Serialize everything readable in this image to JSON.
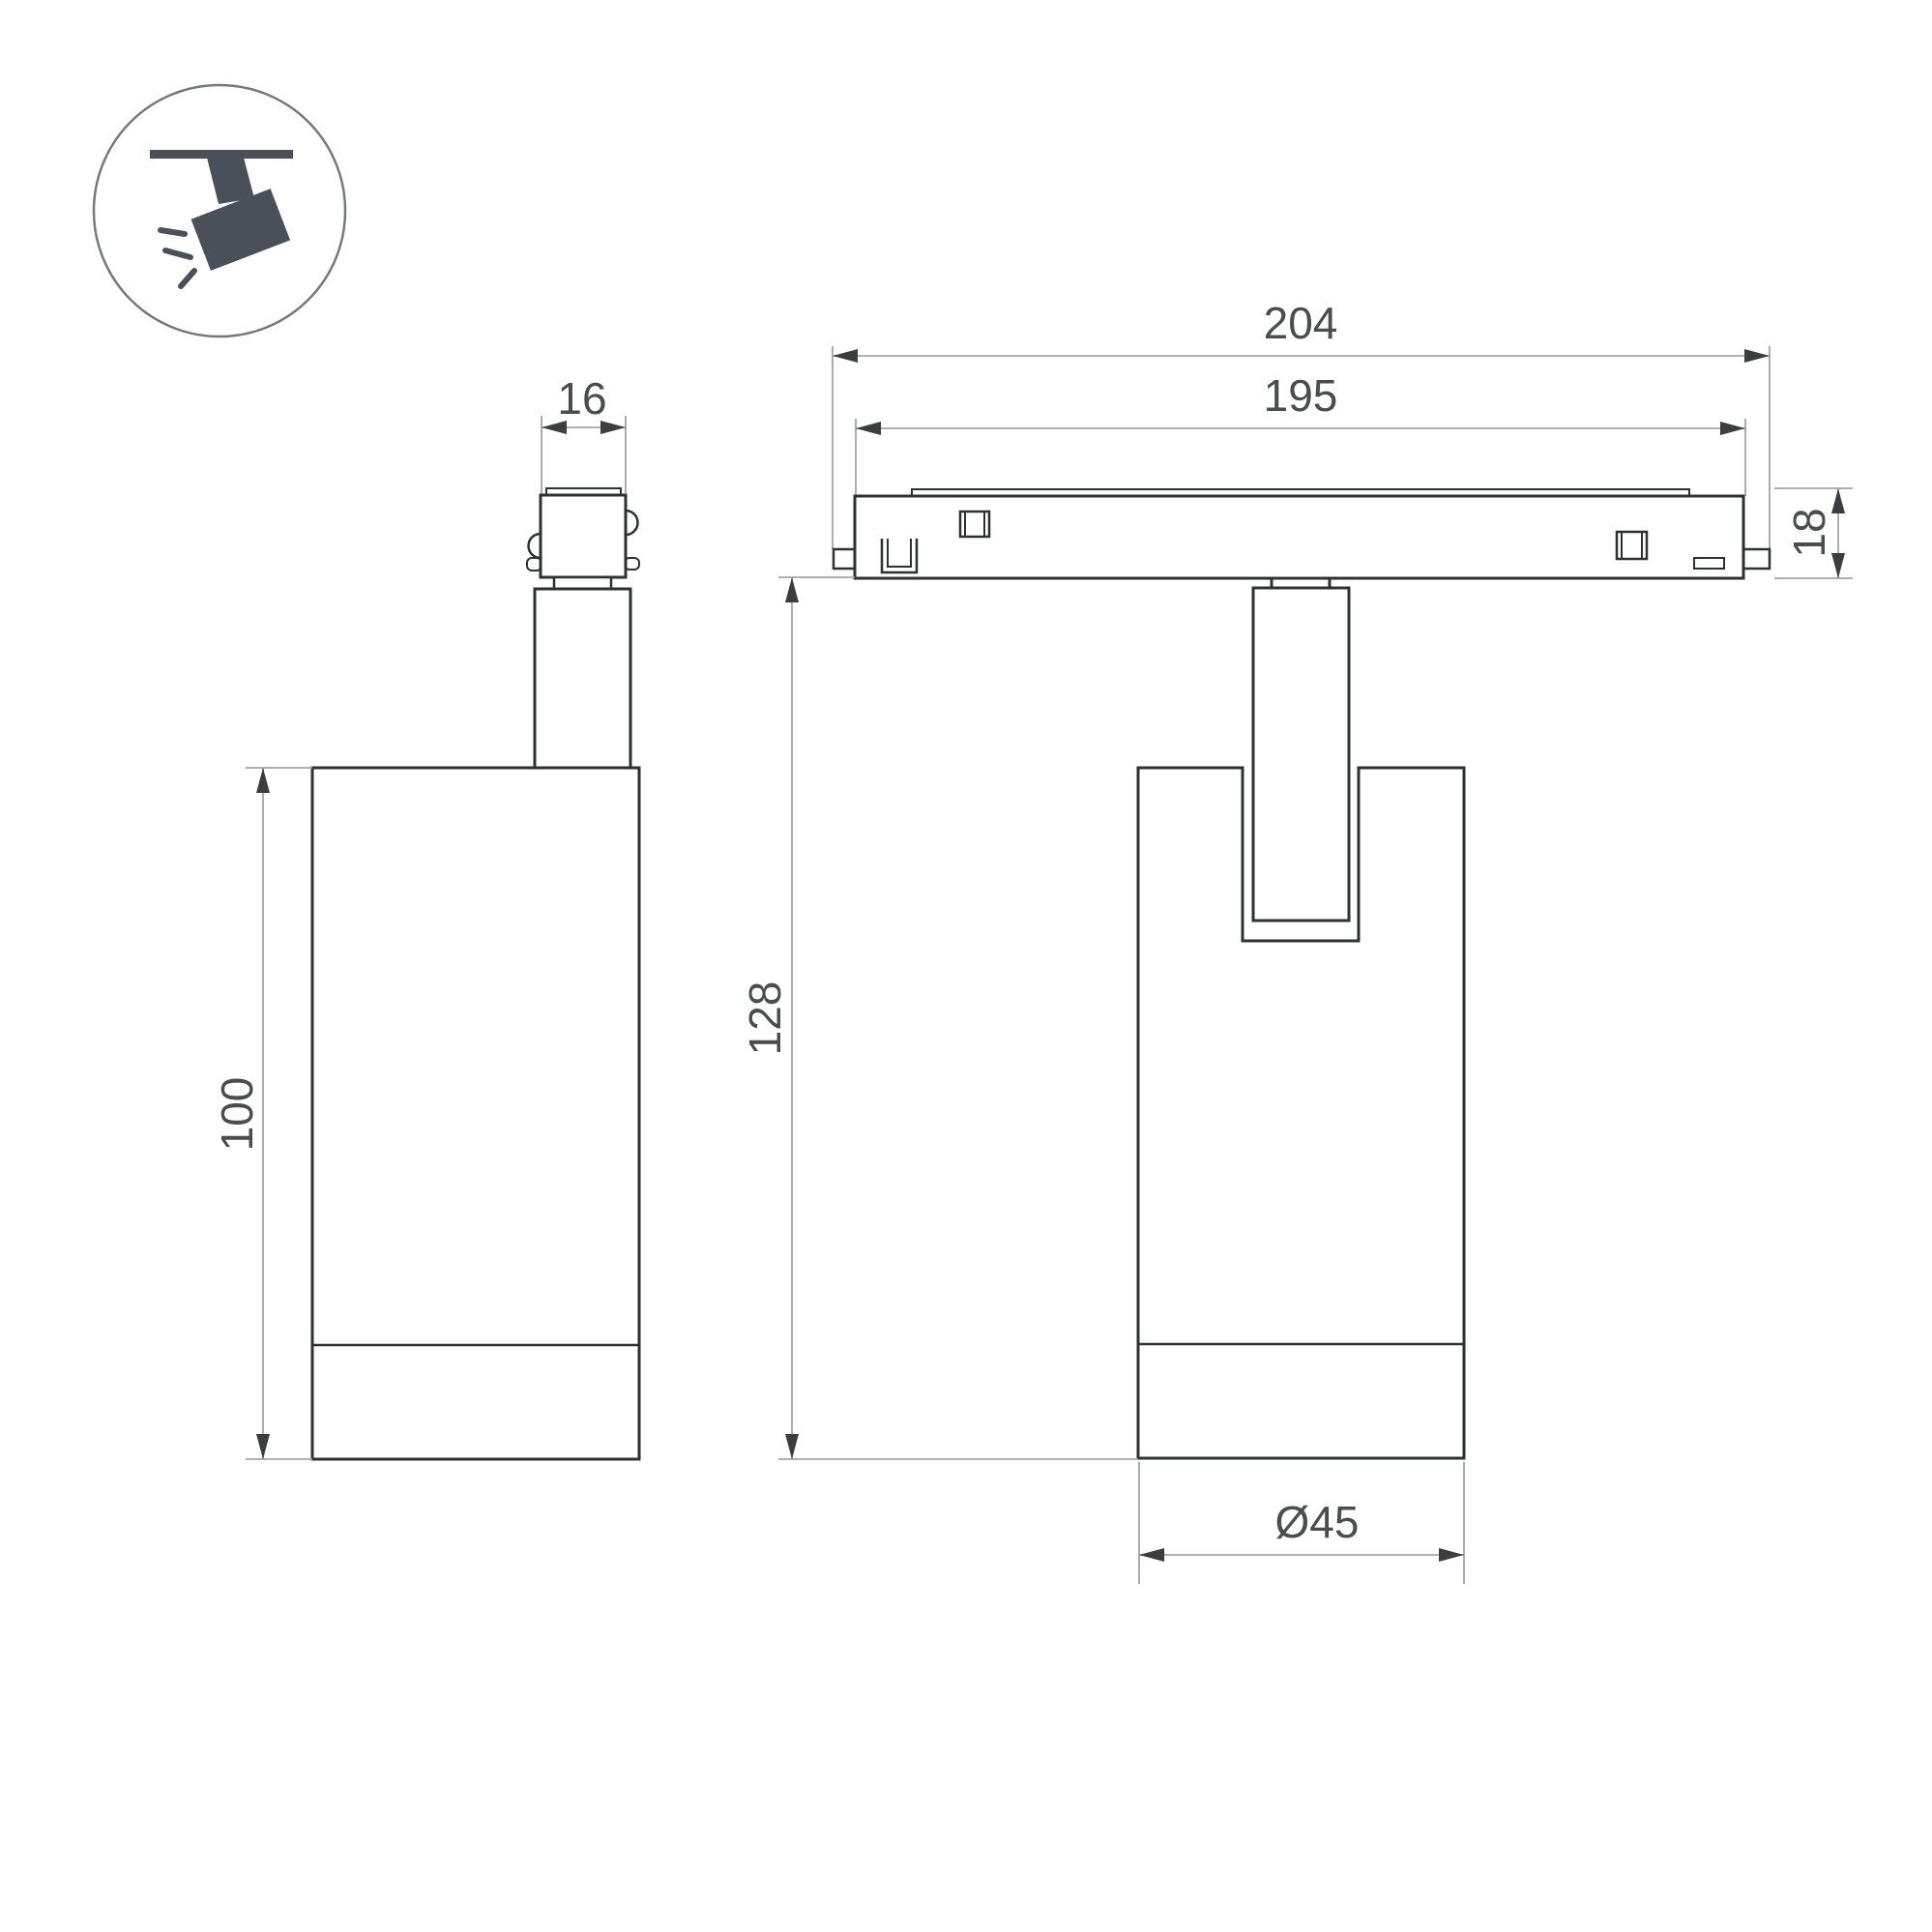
{
  "labels": {
    "connector_width": "16",
    "overall_length": "204",
    "track_length": "195",
    "track_height": "18",
    "total_height": "128",
    "body_height": "100",
    "body_diameter": "Ø45"
  },
  "colors": {
    "background": "#ffffff",
    "outline": "#2e3133",
    "dimension_line": "#a2a5a7",
    "arrow": "#3b3e40",
    "label_text": "#4a4d4f",
    "icon_fill": "#4a5059",
    "icon_circle_stroke": "#75797c"
  }
}
